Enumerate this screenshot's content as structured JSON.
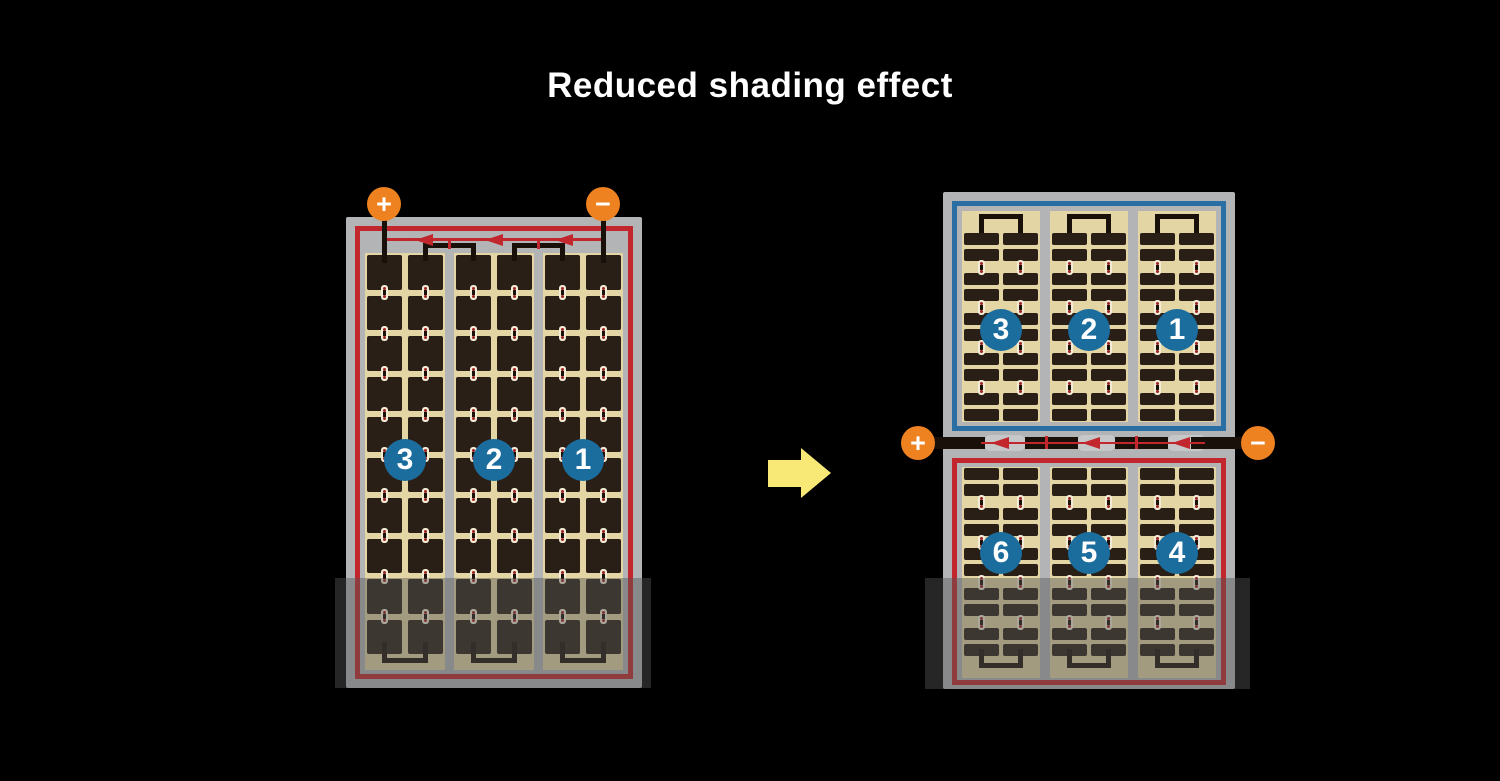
{
  "title": "Reduced shading effect",
  "colors": {
    "title": "#ffffff",
    "frame": "#b3b4b6",
    "tan": "#e4d5a5",
    "cell": "#2a1f17",
    "wire": "#191009",
    "red": "#c1272d",
    "blue": "#2a6fa3",
    "badge": "#1b6d9e",
    "orange": "#ee8220",
    "yellow": "#f8e876",
    "pillbg": "#f3ecd6",
    "pilldot": "#a12222",
    "pilldash": "#1a1008",
    "capsule": "#c6c7c9",
    "shade": "rgba(85,85,85,0.45)"
  },
  "left_module": {
    "terminals": {
      "positive": "+",
      "negative": "−"
    },
    "string_labels": [
      "3",
      "2",
      "1"
    ],
    "grid": {
      "strings": 3,
      "columns_per_string": 2,
      "rows": 10
    },
    "bypass_diodes": 3
  },
  "right_module": {
    "terminals": {
      "positive": "+",
      "negative": "−"
    },
    "top_string_labels": [
      "3",
      "2",
      "1"
    ],
    "bottom_string_labels": [
      "6",
      "5",
      "4"
    ],
    "grid": {
      "strings_per_half": 3,
      "columns_per_string": 2,
      "cell_rows_per_half": 10
    },
    "bypass_diodes": 3
  }
}
